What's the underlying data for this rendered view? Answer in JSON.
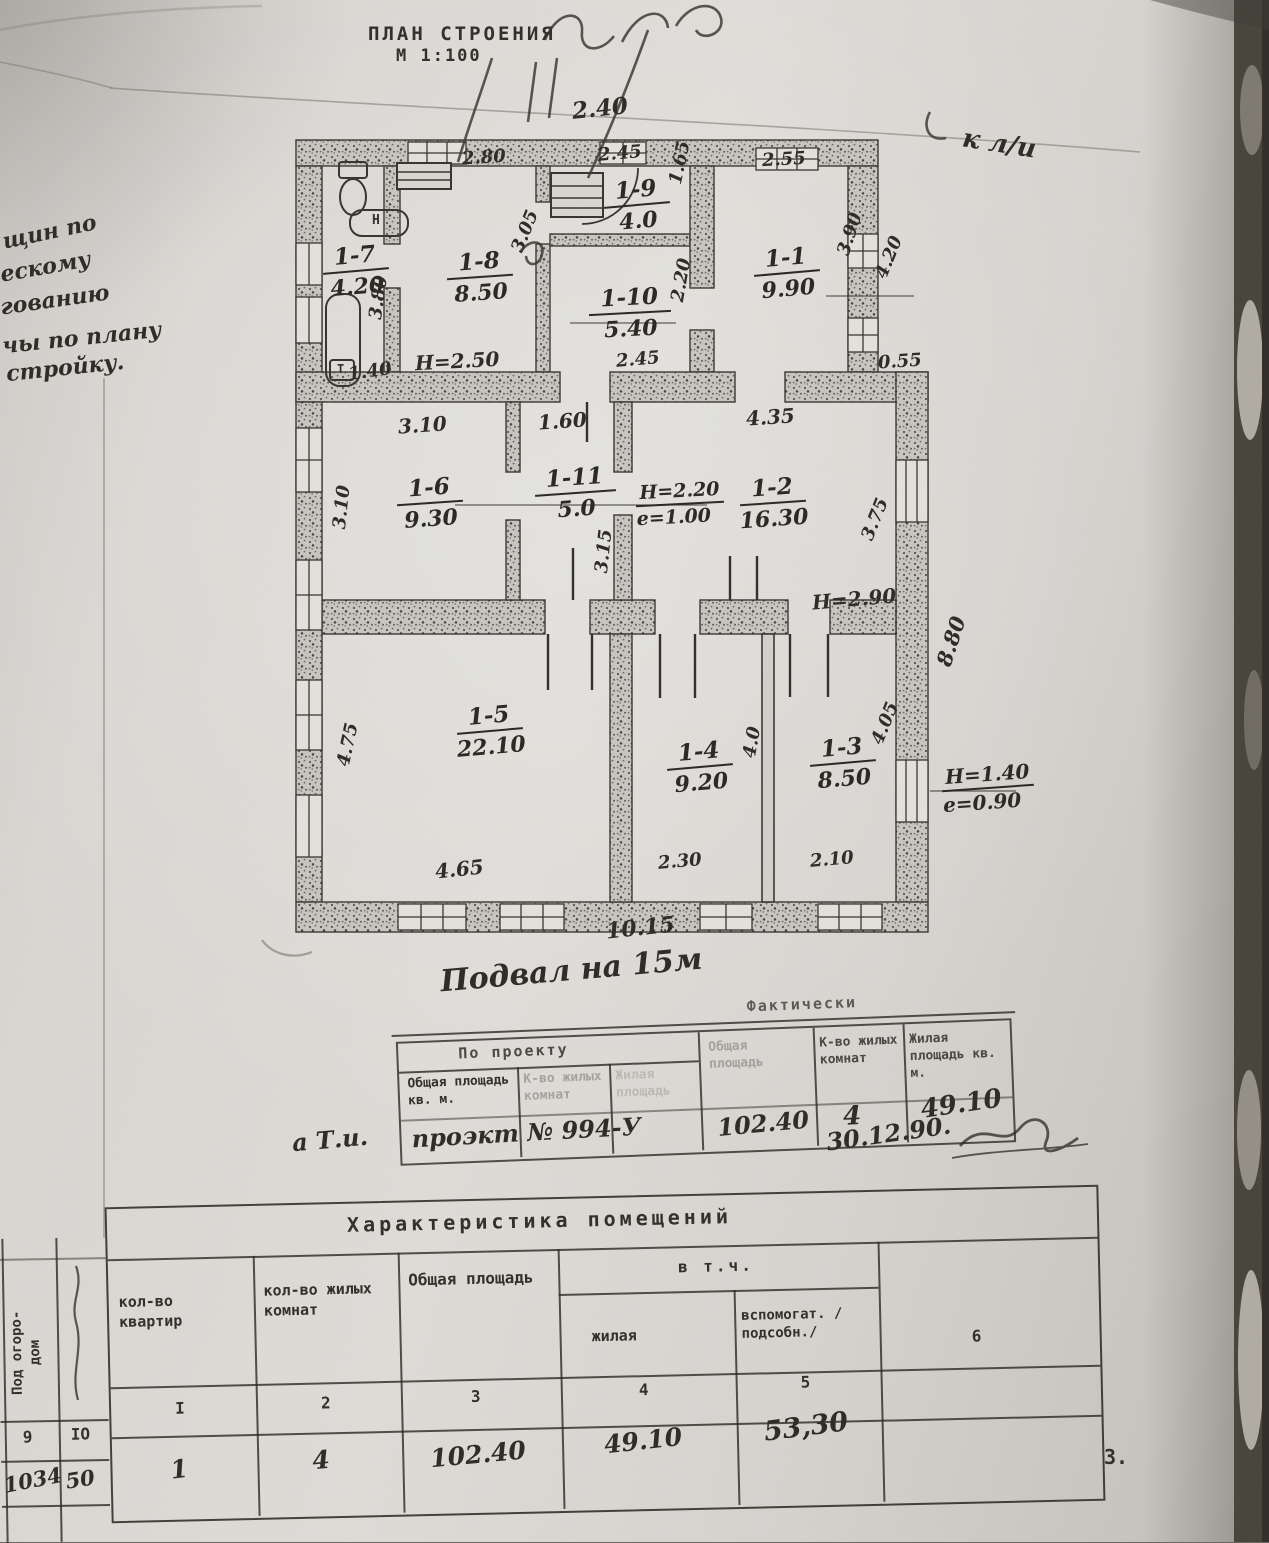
{
  "page": {
    "number": "3."
  },
  "title": {
    "name": "ПЛАН СТРОЕНИЯ",
    "scale": "М 1:100"
  },
  "annotations": {
    "top_right": "к л/и",
    "top_dim": "2.40",
    "basement": "Подвал на 15м",
    "near_table": "а Т.и.",
    "date": "30.12.90.",
    "left_margin": [
      "щин  по",
      "ескому",
      "гованию",
      "чы по плану",
      "стройку."
    ]
  },
  "rooms": [
    {
      "id": "1-7",
      "area": "4.20"
    },
    {
      "id": "1-8",
      "area": "8.50"
    },
    {
      "id": "1-9",
      "area": "4.0"
    },
    {
      "id": "1-10",
      "area": "5.40"
    },
    {
      "id": "1-1",
      "area": "9.90"
    },
    {
      "id": "1-6",
      "area": "9.30"
    },
    {
      "id": "1-11",
      "area": "5.0"
    },
    {
      "id": "1-2",
      "area": "16.30"
    },
    {
      "id": "1-5",
      "area": "22.10"
    },
    {
      "id": "1-4",
      "area": "9.20"
    },
    {
      "id": "1-3",
      "area": "8.50"
    }
  ],
  "dims": {
    "t280": "2.80",
    "t245": "2.45",
    "t165": "1.65",
    "t255": "2.55",
    "l380": "3.80",
    "r305": "3.05",
    "r220": "2.20",
    "r390": "3.90",
    "r420": "4.20",
    "b140": "1.40",
    "h250": "Н=2.50",
    "b245": "2.45",
    "s055": "0.55",
    "t310": "3.10",
    "l310": "3.10",
    "t160": "1.60",
    "t435": "4.35",
    "r375": "3.75",
    "c315": "3.15",
    "h220": "Н=2.20",
    "e100": "е=1.00",
    "h290": "Н=2.90",
    "r880": "8.80",
    "l475": "4.75",
    "b465": "4.65",
    "c40": "4.0",
    "r405": "4.05",
    "b230": "2.30",
    "b210": "2.10",
    "h140": "Н=1.40",
    "e090": "е=0.90",
    "b1015": "10.15"
  },
  "fixtures": {
    "boiler": "Н",
    "tank": "Т"
  },
  "mid_table": {
    "project_header": "По проекту",
    "actual_header": "Фактически",
    "col_total": "Общая площадь кв. м.",
    "col_rooms": "К-во жилых комнат",
    "col_living": "Жилая площадь",
    "col_total2": "Общая площадь",
    "col_rooms2": "К-во жилых комнат",
    "col_living2": "Жилая площадь кв. м.",
    "hw_project": "проэкт № 994-У",
    "hw_total": "102.40",
    "hw_rooms": "4",
    "hw_living": "49.10"
  },
  "bottom_table": {
    "title": "Характеристика  помещений",
    "incl": "в  т.ч.",
    "col1": "кол-во квартир",
    "col2": "кол-во жилых комнат",
    "col3": "Общая площадь",
    "col4": "жилая",
    "col5": "вспомогат. /подсобн./",
    "col6": "6",
    "num_row": [
      "I",
      "2",
      "3",
      "4",
      "5"
    ],
    "val_row": [
      "1",
      "4",
      "102.40",
      "49.10",
      "53,30"
    ]
  },
  "left_table": {
    "header": "Под огоро-",
    "header2": "дом",
    "r1c1": "9",
    "r1c2": "IO",
    "r2c1": "1034",
    "r2c2": "50"
  }
}
